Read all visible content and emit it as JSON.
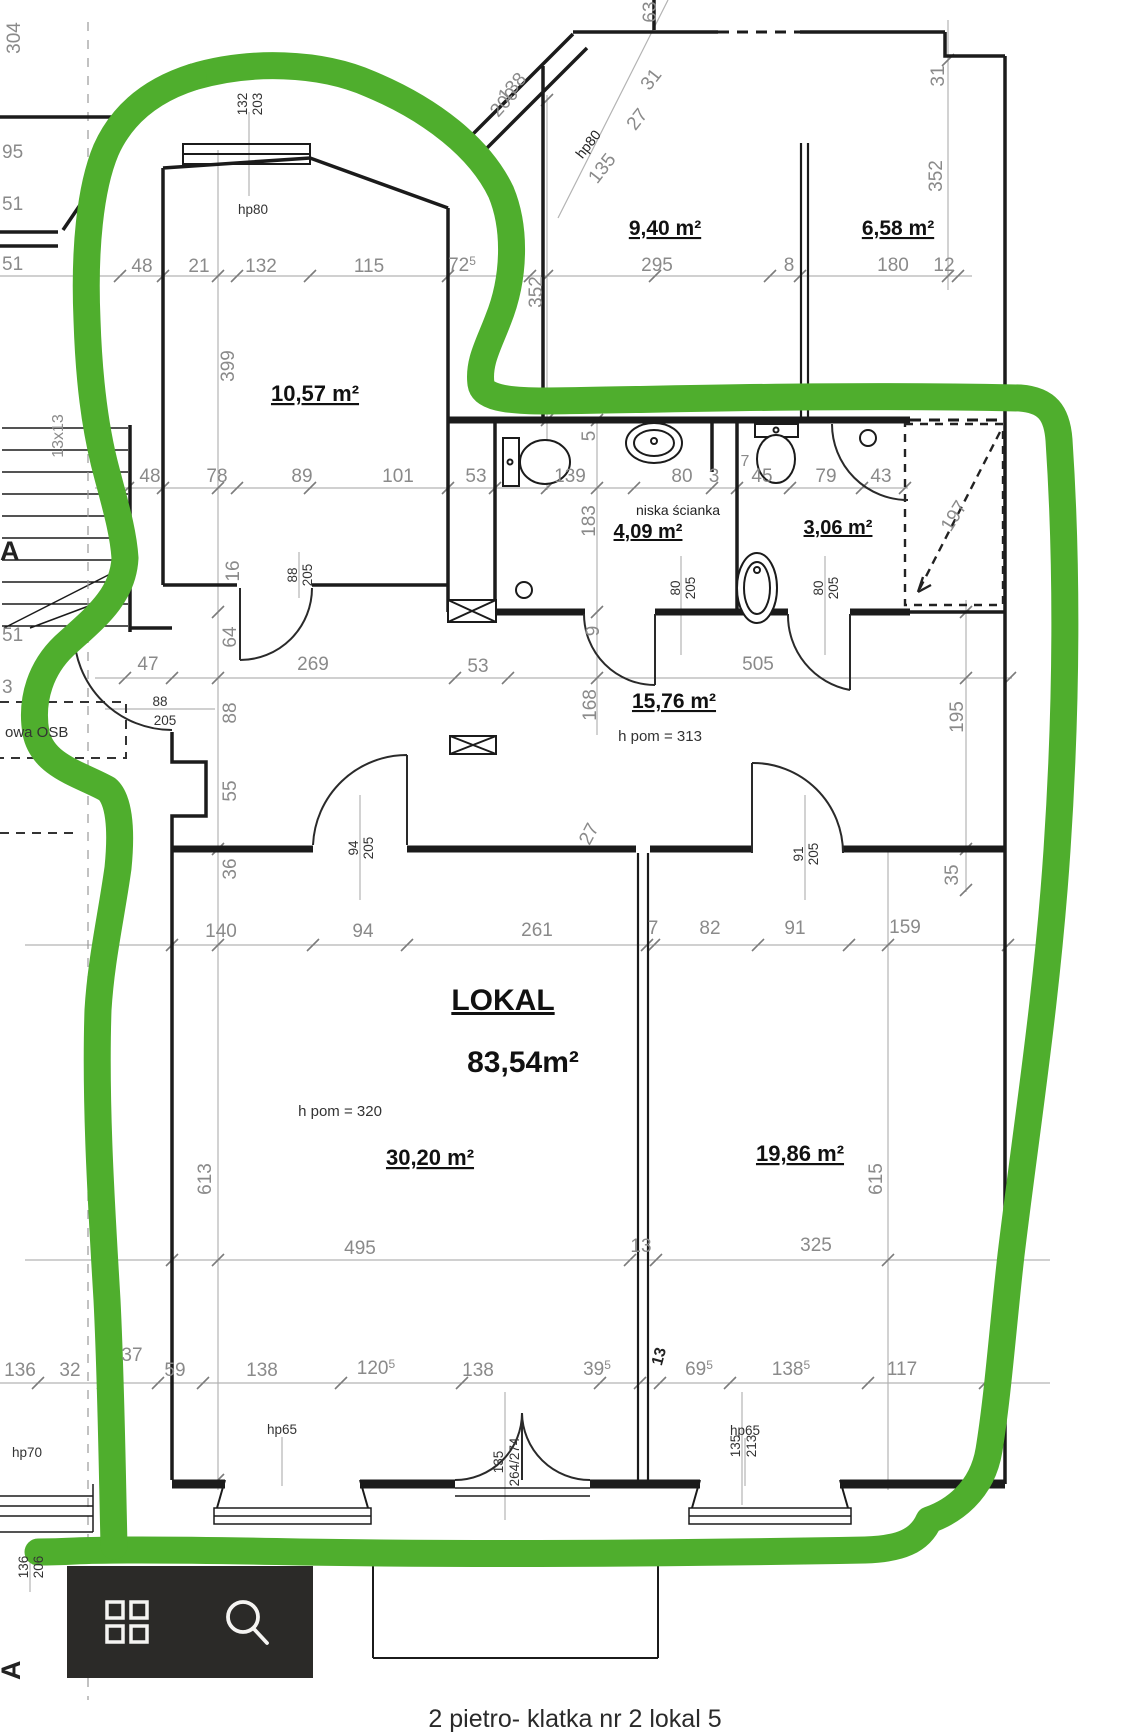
{
  "caption": "2 pietro- klatka nr 2 lokal 5",
  "colors": {
    "marker": "#4fae2d",
    "toolbar_bg": "#2b2a28",
    "wall": "#1b1b1b",
    "dim": "#8a8a8a"
  },
  "icons": {
    "grid": "apps-grid-icon",
    "search": "magnifier-icon"
  },
  "labels": {
    "a940": "9,40 m²",
    "a658": "6,58 m²",
    "a1057": "10,57 m²",
    "a409": "4,09 m²",
    "a306": "3,06 m²",
    "a1576": "15,76 m²",
    "lokal": "LOKAL",
    "lokal_area": "83,54m²",
    "a3020": "30,20 m²",
    "a1986": "19,86 m²",
    "hpom313": "h pom = 313",
    "hpom320": "h pom = 320",
    "niska": "niska ścianka",
    "osb": "owa OSB",
    "t48": "48",
    "t21": "21",
    "t132": "132",
    "t115": "115",
    "t72": "72",
    "t72s": "5",
    "t295": "295",
    "t8": "8",
    "t180": "180",
    "t12": "12",
    "m48": "48",
    "m78": "78",
    "m89": "89",
    "m101": "101",
    "m53": "53",
    "m139": "139",
    "m80": "80",
    "m3": "3",
    "m45": "45",
    "m79": "79",
    "m43": "43",
    "m7": "7",
    "h47": "47",
    "h269": "269",
    "h53": "53",
    "h505": "505",
    "r140": "140",
    "r94": "94",
    "r261": "261",
    "r7": "7",
    "r82": "82",
    "r91": "91",
    "r159": "159",
    "q495": "495",
    "q13": "13",
    "q325": "325",
    "b136": "136",
    "b32": "32",
    "b37": "37",
    "b59": "59",
    "b138a": "138",
    "b120": "120",
    "b120s": "5",
    "b138b": "138",
    "b39": "39",
    "b39s": "5",
    "b13": "13",
    "b69": "69",
    "b69s": "5",
    "b138c": "138",
    "b138cs": "5",
    "b117": "117",
    "v304": "304",
    "v399": "399",
    "v352l": "352",
    "v352r": "352",
    "v31r": "31",
    "v63": "63",
    "v183": "183",
    "v5": "5",
    "v16": "16",
    "v64": "64",
    "v88": "88",
    "v55": "55",
    "v36": "36",
    "h9": "9",
    "h168": "168",
    "h195": "195",
    "v27": "27",
    "v35": "35",
    "v613": "613",
    "v615": "615",
    "d138": "138",
    "d200": "200",
    "dhp80": "hp80",
    "d135": "135",
    "d27": "27",
    "d31": "31",
    "d197": "197",
    "e95": "95",
    "e51a": "51",
    "e51b": "51",
    "e51c": "51",
    "e3": "3",
    "e13x": "13x13",
    "eA1": "A",
    "eA2": "A",
    "f132": "132",
    "f203": "203",
    "fhp80": "hp80",
    "f88a": "88",
    "f205a": "205",
    "f88b": "88",
    "f205b": "205",
    "f80a": "80",
    "f205c": "205",
    "f80b": "80",
    "f205d": "205",
    "f94": "94",
    "f205e": "205",
    "f91": "91",
    "f205f": "205",
    "f135a": "135",
    "f264": "264/274",
    "f135b": "135",
    "f213": "213",
    "f136": "136",
    "f206": "206",
    "hp65a": "hp65",
    "hp65b": "hp65",
    "hp70": "hp70"
  }
}
